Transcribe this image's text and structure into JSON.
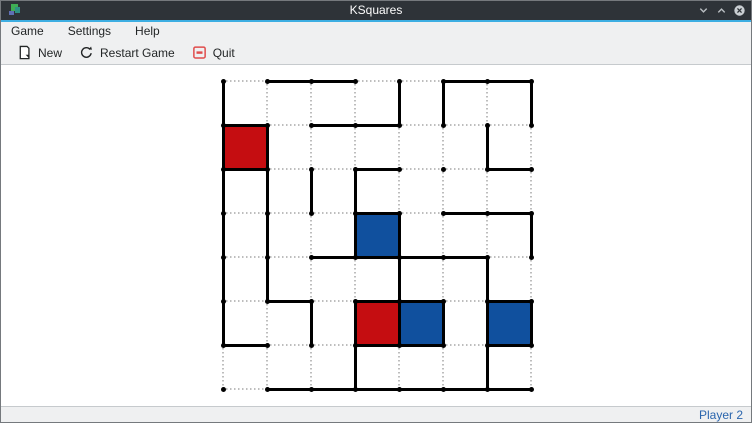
{
  "window": {
    "title": "KSquares",
    "controls": [
      "minimize",
      "maximize",
      "close"
    ]
  },
  "menu_bar": {
    "items": [
      "Game",
      "Settings",
      "Help"
    ]
  },
  "toolbar": {
    "buttons": [
      {
        "label": "New",
        "icon": "new-document-icon"
      },
      {
        "label": "Restart Game",
        "icon": "restart-icon"
      },
      {
        "label": "Quit",
        "icon": "quit-icon"
      }
    ]
  },
  "status_bar": {
    "player_turn": "Player 2"
  },
  "colors": {
    "titlebar_bg": "#2e3338",
    "titlebar_text": "#fcfcfc",
    "accent": "#3daee2",
    "chrome_bg": "#eff0f1",
    "chrome_text": "#232627",
    "window_border": "#75797d",
    "separator": "#c6cacd",
    "board_bg": "#ffffff",
    "drawn_line": "#000000",
    "empty_line": "#bdbdbd",
    "dot": "#000000",
    "player1": "#c50d11",
    "player2": "#10509e",
    "status_text": "#2a65ad",
    "quit_icon": "#e04c4c",
    "icon_stroke": "#232627",
    "winctl_glyph": "#b9bec2",
    "close_circle": "#c9ced2"
  },
  "board": {
    "dot_cols": 8,
    "dot_rows": 8,
    "origin_x": 222,
    "origin_y": 80,
    "spacing": 44,
    "legend": {
      "s": "line drawn",
      "d": "line not drawn (dotted placeholder)"
    },
    "h_lines": [
      "dssddss",
      "sdssddd",
      "sddsdds",
      "dddsdss",
      "ddssssd",
      "dsdssds",
      "sddssds",
      "dssssss"
    ],
    "v_lines": [
      "sdddssds",
      "ssddddsd",
      "ssssdddd",
      "ssdssdds",
      "ssddsdsd",
      "sdssssss",
      "dddsddsd"
    ],
    "filled_cells": [
      {
        "row": 1,
        "col": 0,
        "owner": "player1"
      },
      {
        "row": 3,
        "col": 3,
        "owner": "player2"
      },
      {
        "row": 5,
        "col": 3,
        "owner": "player1"
      },
      {
        "row": 5,
        "col": 4,
        "owner": "player2"
      },
      {
        "row": 5,
        "col": 6,
        "owner": "player2"
      }
    ],
    "score_summary": {
      "player1_boxes": 2,
      "player2_boxes": 3
    }
  }
}
